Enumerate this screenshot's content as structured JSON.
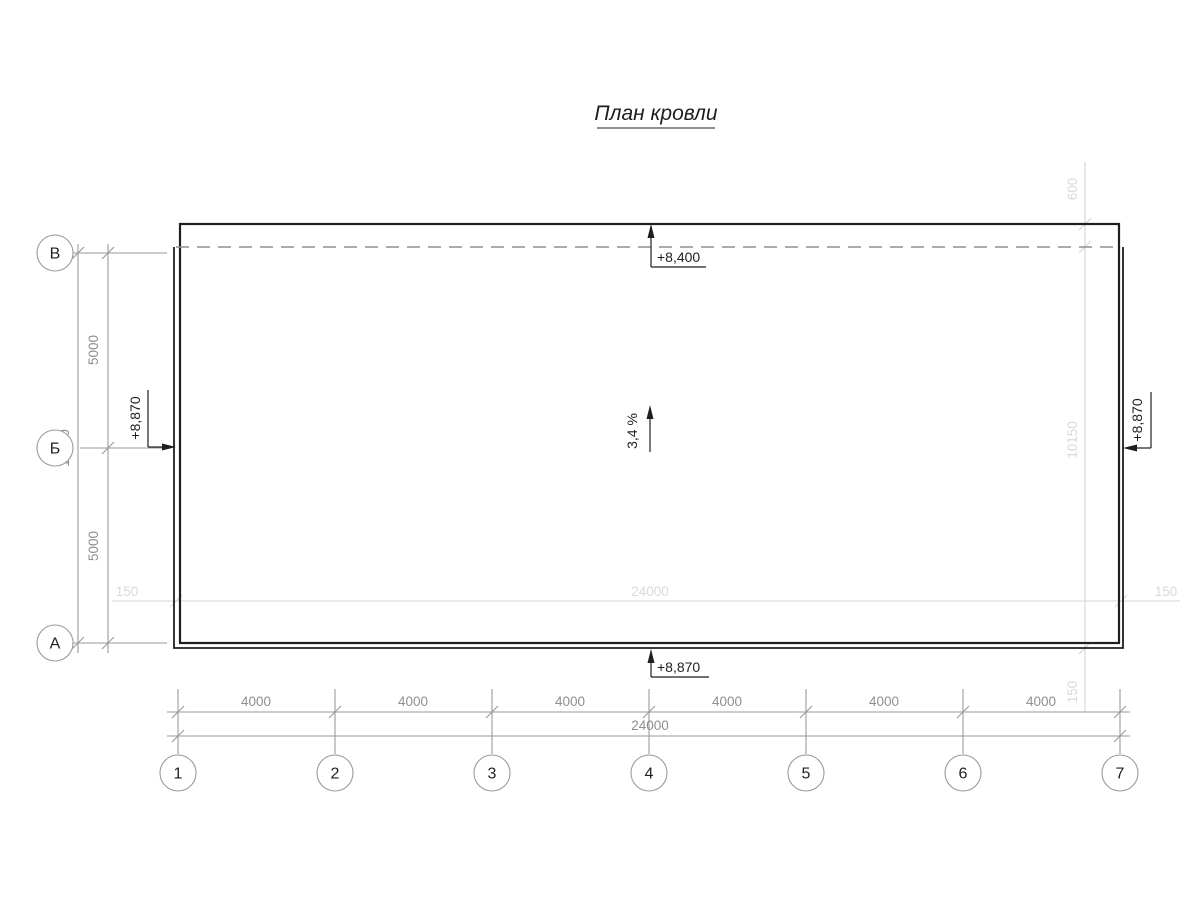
{
  "title": "План кровли",
  "colors": {
    "ink": "#1f1f1f",
    "dim": "#9a9a9a",
    "dimtext": "#8f8f8f",
    "faint": "#d4d4d4",
    "fainttext": "#d9d9d9",
    "dash": "#8f8f8f",
    "paper": "#ffffff"
  },
  "axes": {
    "vertical": [
      "В",
      "Б",
      "А"
    ],
    "horizontal": [
      "1",
      "2",
      "3",
      "4",
      "5",
      "6",
      "7"
    ]
  },
  "elevations": {
    "top": "+8,400",
    "bottom": "+8,870",
    "left": "+8,870",
    "right": "+8,870"
  },
  "slope": "3,4 %",
  "dims": {
    "left_upper": "5000",
    "left_lower": "5000",
    "left_total": "10000",
    "bays": [
      "4000",
      "4000",
      "4000",
      "4000",
      "4000",
      "4000"
    ],
    "bottom_total": "24000",
    "parapet_top": "600",
    "right_inner_span": "10150",
    "parapet_bottom": "150",
    "parapet_left": "150",
    "roof_span": "24000",
    "parapet_right": "150"
  }
}
